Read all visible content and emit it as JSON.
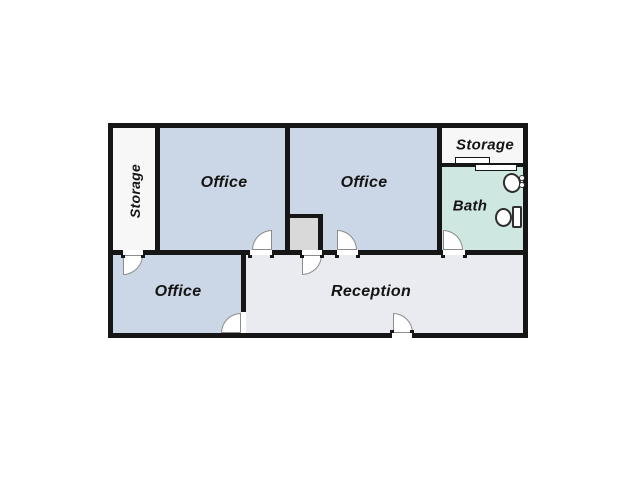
{
  "page": {
    "background": "#ffffff"
  },
  "plan": {
    "wall_color": "#161616",
    "door_color": "#8c8c8c",
    "fixture_color": "#2e2e2e",
    "label_color": "#141414",
    "rooms": [
      {
        "id": "storage-left",
        "label": "Storage",
        "x": 113,
        "y": 128,
        "w": 42,
        "h": 122,
        "fill": "#f7f7f7",
        "lx": 135,
        "ly": 191,
        "rot": -90,
        "fs": 14
      },
      {
        "id": "office-top-left",
        "label": "Office",
        "x": 160,
        "y": 128,
        "w": 125,
        "h": 122,
        "fill": "#cbd7e6",
        "lx": 224,
        "ly": 183,
        "rot": 0,
        "fs": 16
      },
      {
        "id": "office-top-middle",
        "label": "Office",
        "x": 290,
        "y": 128,
        "w": 147,
        "h": 122,
        "fill": "#cbd7e6",
        "lx": 364,
        "ly": 183,
        "rot": 0,
        "fs": 16
      },
      {
        "id": "storage-top-right",
        "label": "Storage",
        "x": 442,
        "y": 128,
        "w": 81,
        "h": 35,
        "fill": "#f7f7f7",
        "lx": 485,
        "ly": 145,
        "rot": 0,
        "fs": 15
      },
      {
        "id": "bath",
        "label": "Bath",
        "x": 442,
        "y": 167,
        "w": 81,
        "h": 83,
        "fill": "#cee7e0",
        "lx": 470,
        "ly": 206,
        "rot": 0,
        "fs": 15
      },
      {
        "id": "office-bottom-left",
        "label": "Office",
        "x": 113,
        "y": 255,
        "w": 128,
        "h": 78,
        "fill": "#cbd7e6",
        "lx": 178,
        "ly": 292,
        "rot": 0,
        "fs": 16
      },
      {
        "id": "reception",
        "label": "Reception",
        "x": 246,
        "y": 255,
        "w": 277,
        "h": 78,
        "fill": "#e9ebf1",
        "lx": 371,
        "ly": 292,
        "rot": 0,
        "fs": 16
      },
      {
        "id": "closet",
        "label": "",
        "x": 290,
        "y": 218,
        "w": 28,
        "h": 32,
        "fill": "#d9d9d9",
        "lx": 0,
        "ly": 0,
        "rot": 0,
        "fs": 0
      }
    ],
    "walls": [
      [
        108,
        123,
        420,
        5
      ],
      [
        108,
        333,
        284,
        5
      ],
      [
        412,
        333,
        116,
        5
      ],
      [
        108,
        123,
        5,
        215
      ],
      [
        523,
        123,
        5,
        215
      ],
      [
        155,
        128,
        5,
        122
      ],
      [
        285,
        128,
        5,
        122
      ],
      [
        437,
        128,
        5,
        122
      ],
      [
        442,
        163,
        81,
        4
      ],
      [
        108,
        250,
        15,
        5
      ],
      [
        143,
        250,
        107,
        5
      ],
      [
        272,
        250,
        30,
        5
      ],
      [
        322,
        250,
        15,
        5
      ],
      [
        358,
        250,
        85,
        5
      ],
      [
        465,
        250,
        63,
        5
      ],
      [
        241,
        255,
        5,
        57
      ],
      [
        285,
        214,
        38,
        4
      ],
      [
        318,
        218,
        5,
        32
      ]
    ],
    "jambs": [
      [
        121,
        255,
        4,
        3
      ],
      [
        141,
        255,
        4,
        3
      ],
      [
        248,
        255,
        4,
        3
      ],
      [
        270,
        255,
        4,
        3
      ],
      [
        300,
        255,
        4,
        3
      ],
      [
        320,
        255,
        4,
        3
      ],
      [
        335,
        255,
        4,
        3
      ],
      [
        356,
        255,
        4,
        3
      ],
      [
        441,
        255,
        4,
        3
      ],
      [
        463,
        255,
        4,
        3
      ],
      [
        390,
        330,
        4,
        3
      ],
      [
        410,
        330,
        4,
        3
      ]
    ],
    "doors": [
      {
        "x": 123,
        "y": 255,
        "r": 20,
        "corner": "br"
      },
      {
        "x": 252,
        "y": 230,
        "r": 20,
        "corner": "tl"
      },
      {
        "x": 302,
        "y": 255,
        "r": 20,
        "corner": "br"
      },
      {
        "x": 337,
        "y": 230,
        "r": 20,
        "corner": "tr"
      },
      {
        "x": 443,
        "y": 230,
        "r": 20,
        "corner": "tr"
      },
      {
        "x": 393,
        "y": 313,
        "r": 20,
        "corner": "tr"
      },
      {
        "x": 221,
        "y": 313,
        "r": 20,
        "corner": "tl"
      }
    ],
    "sliding_door": [
      [
        455,
        157,
        35,
        7
      ],
      [
        475,
        164,
        42,
        7
      ]
    ],
    "bath_fixtures": {
      "sink_basin": {
        "x": 503,
        "y": 173,
        "w": 18,
        "h": 20,
        "rot": -15
      },
      "sink_knobs": [
        [
          519,
          175,
          6
        ],
        [
          519,
          182,
          6
        ]
      ],
      "toilet_tank": {
        "x": 512,
        "y": 206,
        "w": 10,
        "h": 22
      },
      "toilet_bowl": {
        "x": 495,
        "y": 208,
        "w": 17,
        "h": 19
      }
    }
  }
}
